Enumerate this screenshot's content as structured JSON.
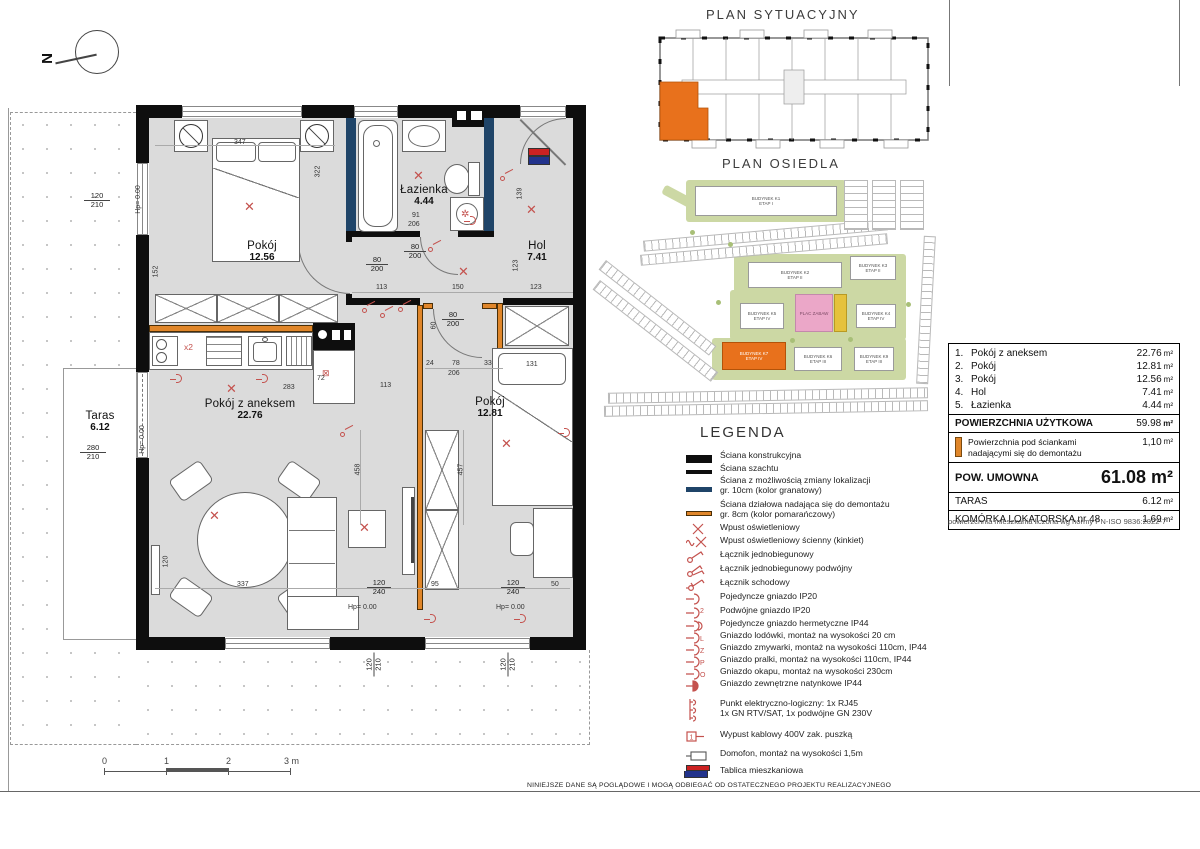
{
  "north": {
    "label": "N"
  },
  "titles": {
    "sytuacyjny": "PLAN SYTUACYJNY",
    "osiedle": "PLAN OSIEDLA",
    "legenda": "LEGENDA"
  },
  "plan": {
    "rooms_labels": {
      "p1": {
        "name": "Pokój",
        "area": "12.56"
      },
      "laz": {
        "name": "Łazienka",
        "area": "4.44"
      },
      "hol": {
        "name": "Hol",
        "area": "7.41"
      },
      "anek": {
        "name": "Pokój z aneksem",
        "area": "22.76"
      },
      "p2": {
        "name": "Pokój",
        "area": "12.81"
      },
      "taras": {
        "name": "Taras",
        "area": "6.12"
      }
    },
    "kitchen_x2": "x2",
    "dims": {
      "d347": "347",
      "d322": "322",
      "d152": "152",
      "d113": "113",
      "d150": "150",
      "d123": "123",
      "d91": "91",
      "d206": "206",
      "d24": "24",
      "d78": "78",
      "d33": "33",
      "d72": "72",
      "d60": "60",
      "d283": "283",
      "d458": "458",
      "d457": "457",
      "d131": "131",
      "d337": "337",
      "d95": "95",
      "d50": "50",
      "d120": "120",
      "d210": "210",
      "d240": "240",
      "d280": "280",
      "d80": "80",
      "d200": "200",
      "hp": "Hp= 0.00"
    }
  },
  "osiedle": {
    "buildings": [
      {
        "l1": "BUDYNEK K1",
        "l2": "ETAP I"
      },
      {
        "l1": "BUDYNEK K2",
        "l2": "ETAP II"
      },
      {
        "l1": "BUDYNEK K3",
        "l2": "ETAP II"
      },
      {
        "l1": "BUDYNEK K5",
        "l2": "ETAP IV"
      },
      {
        "l1": "BUDYNEK K4",
        "l2": "ETAP IV"
      },
      {
        "l1": "BUDYNEK K7",
        "l2": "ETAP IV"
      },
      {
        "l1": "BUDYNEK K6",
        "l2": "ETAP III"
      },
      {
        "l1": "BUDYNEK K9",
        "l2": "ETAP III"
      }
    ],
    "plac_zabaw": "PLAC ZABAW"
  },
  "table": {
    "unit": "m²",
    "rooms": [
      {
        "num": "1.",
        "name": "Pokój z aneksem",
        "area": "22.76"
      },
      {
        "num": "2.",
        "name": "Pokój",
        "area": "12.81"
      },
      {
        "num": "3.",
        "name": "Pokój",
        "area": "12.56"
      },
      {
        "num": "4.",
        "name": "Hol",
        "area": "7.41"
      },
      {
        "num": "5.",
        "name": "Łazienka",
        "area": "4.44"
      }
    ],
    "pu_label": "POWIERZCHNIA UŻYTKOWA",
    "pu_value": "59.98",
    "dem_line1": "Powierzchnia pod ściankami",
    "dem_line2": "nadającymi się do demontażu",
    "dem_value": "1,10",
    "umowna_label": "POW. UMOWNA",
    "umowna_value": "61.08 m²",
    "taras_label": "TARAS",
    "taras_value": "6.12",
    "komorka_label": "KOMÓRKA LOKATORSKA nr 48",
    "komorka_value": "1.69",
    "note": "powierzchnia mieszkania liczona wg normy PN-ISO 9836:2022-7"
  },
  "legend": {
    "title": "LEGENDA",
    "items": [
      {
        "label": "Ściana konstrukcyjna"
      },
      {
        "label": "Ściana szachtu"
      },
      {
        "label": "Ściana z możliwością zmiany lokalizacji",
        "label2": "gr. 10cm (kolor granatowy)"
      },
      {
        "label": "Ściana działowa nadająca się do demontażu",
        "label2": "gr. 8cm (kolor pomarańczowy)"
      },
      {
        "label": "Wpust oświetleniowy"
      },
      {
        "label": "Wpust oświetleniowy ścienny (kinkiet)"
      },
      {
        "label": "Łącznik jednobiegunowy"
      },
      {
        "label": "Łącznik jednobiegunowy podwójny"
      },
      {
        "label": "Łącznik schodowy"
      },
      {
        "label": "Pojedyncze gniazdo IP20"
      },
      {
        "label": "Podwójne gniazdo IP20",
        "letter": "2"
      },
      {
        "label": "Pojedyncze gniazdo hermetyczne IP44"
      },
      {
        "label": "Gniazdo lodówki, montaż na wysokości 20 cm",
        "letter": "L"
      },
      {
        "label": "Gniazdo zmywarki, montaż na wysokości 110cm,  IP44",
        "letter": "Z"
      },
      {
        "label": "Gniazdo pralki, montaż na wysokości 110cm, IP44",
        "letter": "P"
      },
      {
        "label": "Gniazdo okapu, montaż na wysokości 230cm",
        "letter": "O"
      },
      {
        "label": "Gniazdo zewnętrzne natynkowe IP44"
      },
      {
        "label": "Punkt elektryczno-logiczny: 1x RJ45",
        "label2": "1x GN RTV/SAT, 1x podwójne GN 230V"
      },
      {
        "label": "Wypust kablowy 400V zak. puszką"
      },
      {
        "label": "Domofon, montaż na wysokości 1,5m"
      },
      {
        "label": "Tablica mieszkaniowa"
      }
    ]
  },
  "scalebar": {
    "t0": "0",
    "t1": "1",
    "t2": "2",
    "t3": "3 m"
  },
  "disclaimer": "NINIEJSZE DANE SĄ POGLĄDOWE I MOGĄ ODBIEGAĆ OD OSTATECZNEGO PROJEKTU REALIZACYJNEGO",
  "colors": {
    "wall": "#0e0e0e",
    "navy": "#1f4468",
    "orange": "#e0862a",
    "symbol_red": "#c4524e",
    "floor": "#dbdbdb",
    "highlight": "#e8711c"
  }
}
